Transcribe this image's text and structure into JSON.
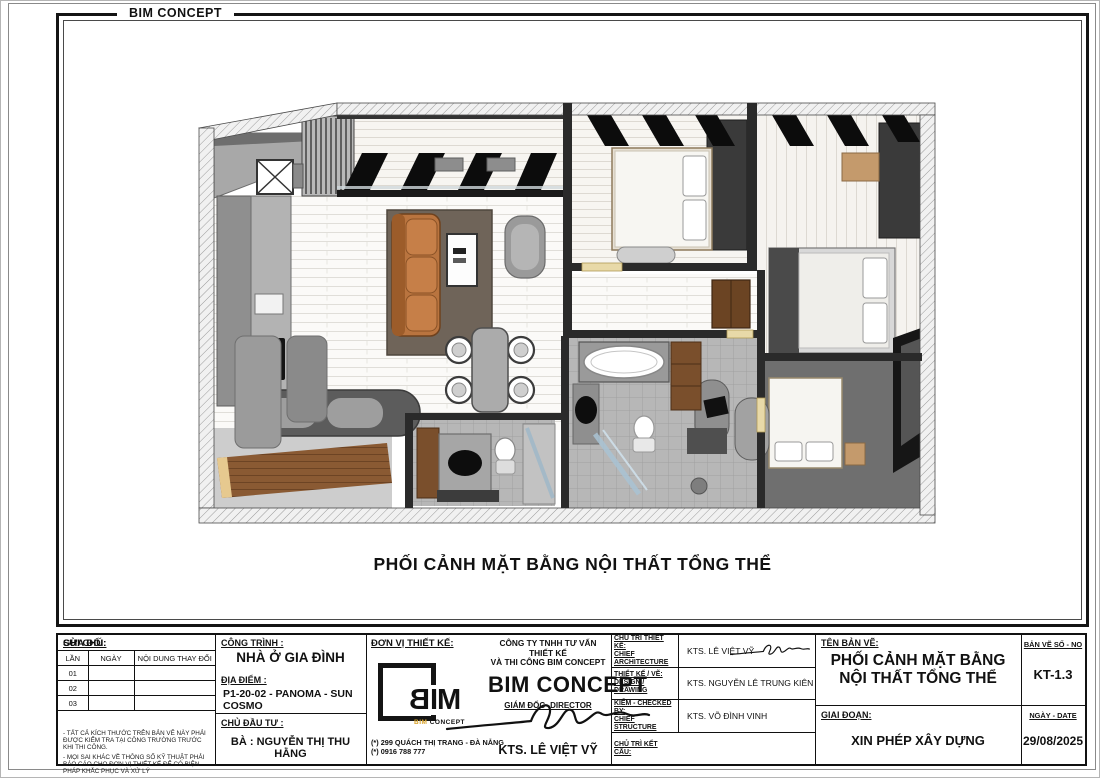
{
  "page": {
    "header_brand": "BIM CONCEPT",
    "drawing_title": "PHỐI CẢNH MẶT BẰNG NỘI THẤT TỔNG THỂ"
  },
  "title_block": {
    "revision": {
      "label": "SỬA ĐỔI:",
      "columns": [
        "LẦN",
        "NGÀY",
        "NỘI DUNG THAY ĐỔI"
      ],
      "rows": [
        "01",
        "02",
        "03"
      ]
    },
    "notes": {
      "label": "GHI CHÚ:",
      "line1": "- TẤT CẢ KÍCH THƯỚC TRÊN BẢN VẼ NÀY PHẢI ĐƯỢC KIỂM TRA TẠI CÔNG TRƯỜNG TRƯỚC KHI THI CÔNG.",
      "line2": "- MỌI SAI KHÁC VỀ THÔNG SỐ KỸ THUẬT PHẢI BÁO CÁO CHO ĐƠN VỊ THIẾT KẾ ĐỂ CÓ BIỆN PHÁP KHẮC PHỤC VÀ XỬ LÝ"
    },
    "project": {
      "label": "CÔNG TRÌNH :",
      "name": "NHÀ Ở GIA ĐÌNH",
      "location_label": "ĐỊA ĐIỂM :",
      "location": "P1-20-02 - PANOMA - SUN COSMO",
      "client_label": "CHỦ ĐẦU TƯ :",
      "client": "BÀ : NGUYỄN THỊ THU HẰNG"
    },
    "designer": {
      "label": "ĐƠN VỊ THIẾT KẾ:",
      "logo": {
        "b": "B",
        "im": "IM",
        "sub_1": "BIM",
        "sub_2": "CONCEPT"
      },
      "company_line1": "CÔNG TY TNHH TƯ VẤN THIẾT KẾ",
      "company_line2": "VÀ THI CÔNG BIM CONCEPT",
      "brand": "BIM CONCEPT",
      "director_label": "GIÁM ĐỐC -DIRECTOR",
      "director_name": "KTS. LÊ VIỆT VỸ",
      "address": "(*) 299 QUÁCH THỊ TRANG - ĐÀ NẴNG",
      "phone": "(*) 0916 788 777"
    },
    "roles": [
      {
        "label1": "CHỦ TRÌ THIẾT KẾ:",
        "label2": "CHIEF ARCHITECTURE",
        "name": "KTS. LÊ VIỆT VỸ"
      },
      {
        "label1": "THIẾT KẾ / VẼ:",
        "label2": "DESIGN / DRAWING",
        "name": "KTS. NGUYỄN LÊ TRUNG KIÊN"
      },
      {
        "label1": "KIỂM - CHECKED BY:",
        "label2": "CHIEF STRUCTURE",
        "name": "KTS. VÕ ĐÌNH VINH"
      },
      {
        "label1": "CHỦ TRÌ KẾT CẤU:",
        "label2": "",
        "name": ""
      }
    ],
    "sheet": {
      "name_label": "TÊN BẢN VẼ:",
      "name": "PHỐI CẢNH MẶT BẰNG NỘI THẤT TỔNG THỂ",
      "stage_label": "GIAI ĐOẠN:",
      "stage": "XIN PHÉP XÂY DỰNG",
      "number_label": "BẢN VẼ SỐ - NO",
      "number": "KT-1.3",
      "date_label": "NGÀY - DATE",
      "date": "29/08/2025"
    }
  },
  "plan": {
    "palette": {
      "sofa": "#b9743f",
      "rug": "#6f6459",
      "wood": "#8a5a33",
      "wall_dark": "#2a2a2a",
      "wall_gray": "#9a9a9a",
      "floor_white": "#fbfaf8",
      "accent_tan": "#c49a6c",
      "logo_orange": "#d9a32a"
    }
  }
}
